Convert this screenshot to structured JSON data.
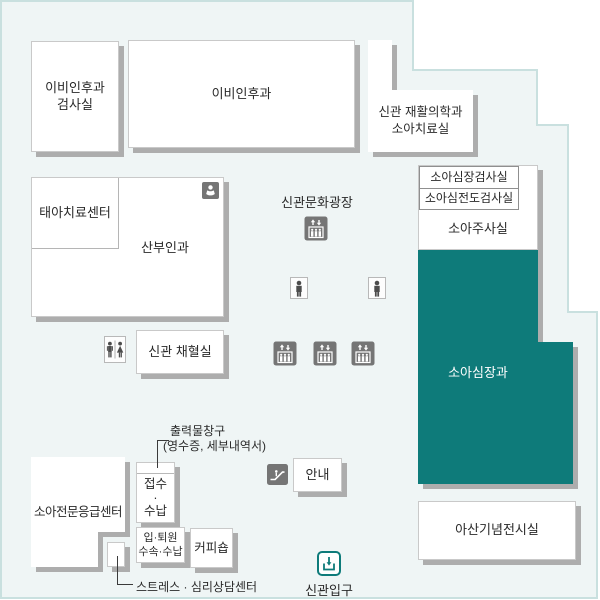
{
  "colors": {
    "teal": "#0e7b7a",
    "floor_background": "#eff5f5",
    "floor_outline": "#c9e0df",
    "box_shadow": "#adadad",
    "icon_gray": "#757575"
  },
  "rooms": {
    "ent_exam": {
      "line1": "이비인후과",
      "line2": "검사실"
    },
    "ent": {
      "label": "이비인후과"
    },
    "rehab": {
      "line1": "신관 재활의학과",
      "line2": "소아치료실"
    },
    "fetal": {
      "label": "태아치료센터"
    },
    "obgyn": {
      "label": "산부인과"
    },
    "blood": {
      "label": "신관 채혈실"
    },
    "heart_exam": {
      "row1": "소아심장검사실",
      "row2": "소아심전도검사실"
    },
    "injection": {
      "label": "소아주사실"
    },
    "cardiology": {
      "label": "소아심장과"
    },
    "memorial": {
      "label": "아산기념전시실"
    },
    "er": {
      "label": "소아전문응급센터"
    },
    "reception": {
      "line1": "접수",
      "dot": "·",
      "line2": "수납"
    },
    "admission": {
      "line1": "입·퇴원",
      "line2": "수속·수납"
    },
    "coffee": {
      "label": "커피숍"
    },
    "info": {
      "label": "안내"
    }
  },
  "labels": {
    "plaza": "신관문화광장",
    "print_counter_1": "출력물창구",
    "print_counter_2": "(영수증, 세부내역서)",
    "stress": "스트레스 · 심리상담센터",
    "entrance": "신관입구"
  },
  "icons": {
    "elevator": "elevator",
    "person": "person",
    "restroom": "restroom",
    "escalator": "escalator",
    "baby_care": "baby-care",
    "entrance_gate": "new-building-entrance"
  }
}
